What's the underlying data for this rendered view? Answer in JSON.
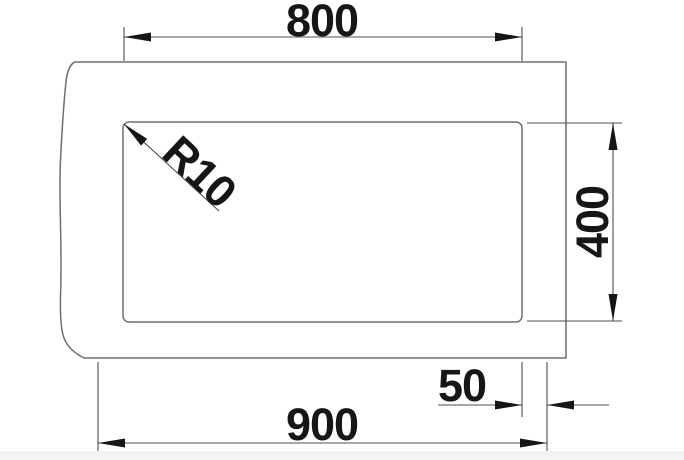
{
  "diagram": {
    "type": "technical-drawing",
    "subject": "sink bowl top view with installation dimensions",
    "labels": {
      "top_width": "800",
      "right_height": "400",
      "bottom_width": "900",
      "edge_offset": "50",
      "corner_radius": "R10"
    },
    "colors": {
      "background": "#ffffff",
      "outline": "#6f6f6f",
      "dimension_line": "#4f4f4f",
      "text_and_arrows": "#161616",
      "footer_bar": "#f3f4f5"
    }
  }
}
